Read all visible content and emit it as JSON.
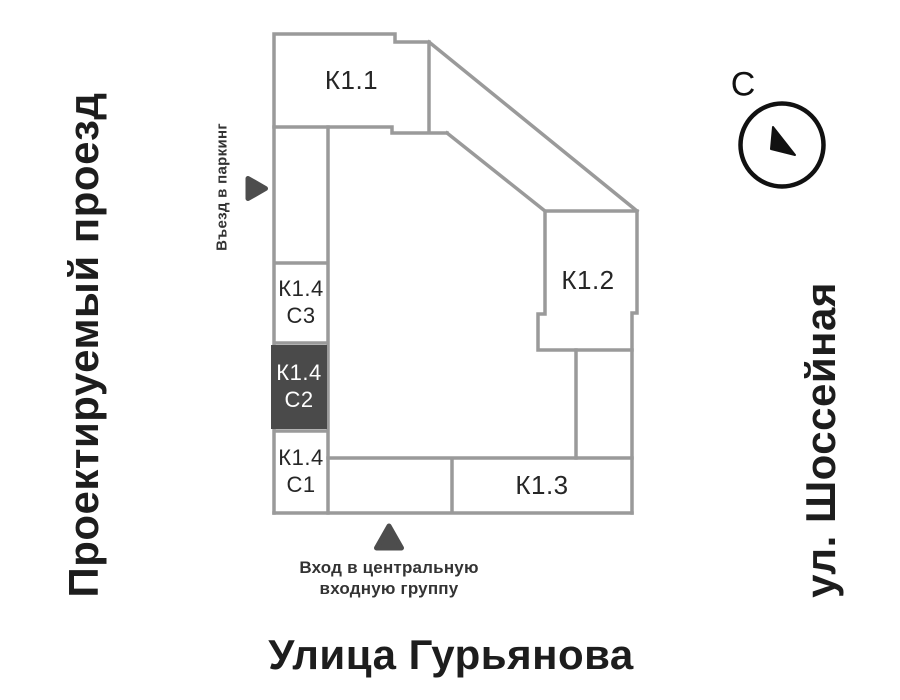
{
  "streets": {
    "left": "Проектируемый проезд",
    "right": "ул. Шоссейная",
    "bottom": "Улица Гурьянова"
  },
  "buildings": [
    {
      "id": "k1-1",
      "label": "К1.1"
    },
    {
      "id": "k1-2",
      "label": "К1.2"
    },
    {
      "id": "k1-3",
      "label": "К1.3"
    },
    {
      "id": "k1-4-c3",
      "label": "К1.4",
      "sub": "С3"
    },
    {
      "id": "k1-4-c2",
      "label": "К1.4",
      "sub": "С2",
      "state": "selected"
    },
    {
      "id": "k1-4-c1",
      "label": "К1.4",
      "sub": "С1"
    }
  ],
  "annotations": {
    "parking": "Въезд в паркинг",
    "entrance": {
      "line1": "Вход в центральную",
      "line2": "входную группу"
    }
  },
  "compass": {
    "north_label": "С"
  },
  "colors": {
    "outline": "#9a9a9a",
    "highlight_block": "#4a4a4a",
    "marker": "#4d4d4d",
    "text": "#1d1d1d"
  }
}
